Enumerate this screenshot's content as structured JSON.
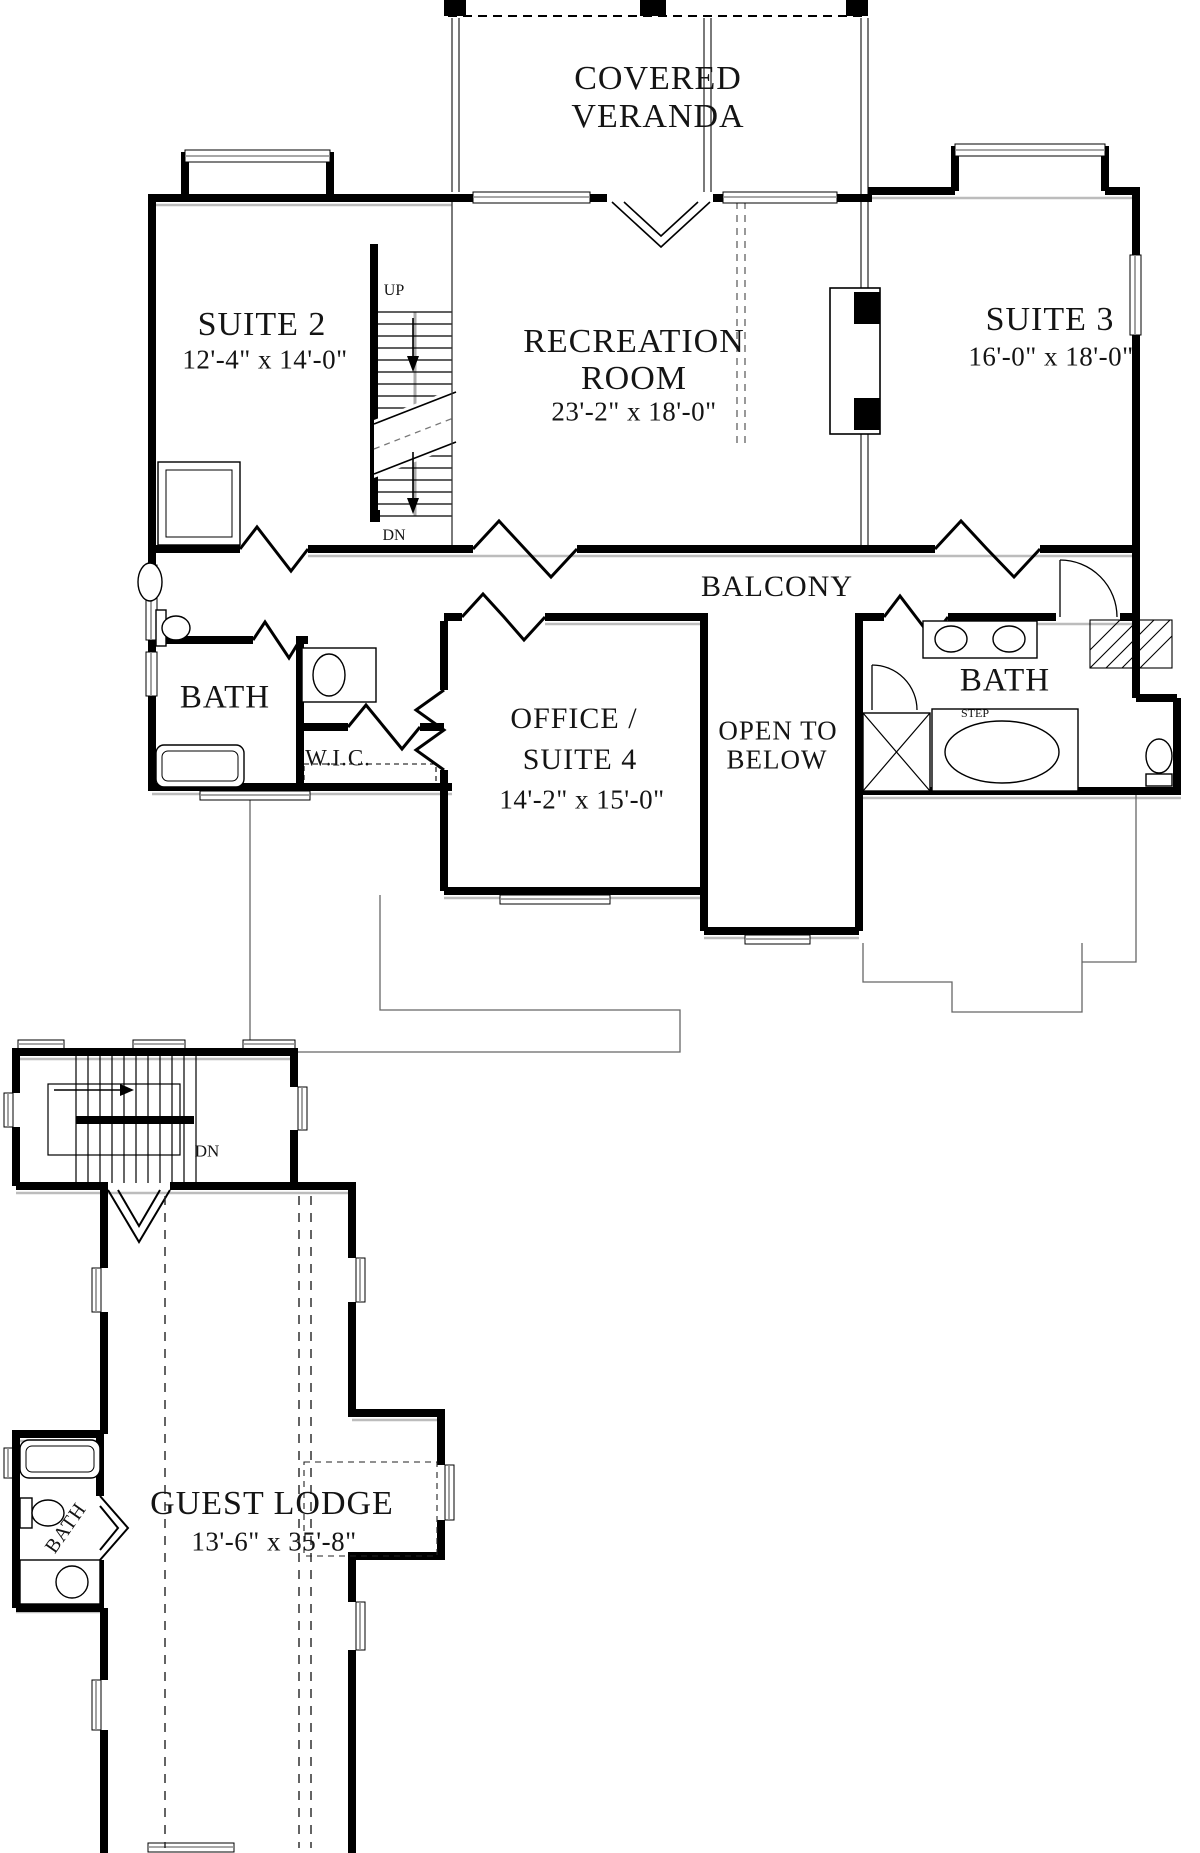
{
  "rooms": {
    "veranda": {
      "name1": "COVERED",
      "name2": "VERANDA"
    },
    "suite2": {
      "name": "SUITE 2",
      "dims": "12'-4\" x 14'-0\""
    },
    "recreation": {
      "name1": "RECREATION",
      "name2": "ROOM",
      "dims": "23'-2\" x 18'-0\""
    },
    "suite3": {
      "name": "SUITE 3",
      "dims": "16'-0\" x 18'-0\""
    },
    "balcony": {
      "name": "BALCONY"
    },
    "bath_left": {
      "name": "BATH"
    },
    "wic": {
      "name": "W.I.C."
    },
    "office": {
      "name1": "OFFICE /",
      "name2": "SUITE 4",
      "dims": "14'-2\" x 15'-0\""
    },
    "open_below": {
      "name1": "OPEN TO",
      "name2": "BELOW"
    },
    "bath_right": {
      "name": "BATH",
      "step_label": "STEP"
    },
    "guest_lodge": {
      "name": "GUEST LODGE",
      "dims": "13'-6\" x 35'-8\""
    },
    "bath_lodge": {
      "name": "BATH"
    }
  },
  "stairs": {
    "main": {
      "up_label": "UP",
      "down_label": "DN"
    },
    "lodge": {
      "down_label": "DN"
    }
  },
  "colors": {
    "wall": "#000000",
    "shadow": "#bcbcbc",
    "window": "#8a8a8a",
    "text": "#141414",
    "background": "#ffffff"
  }
}
